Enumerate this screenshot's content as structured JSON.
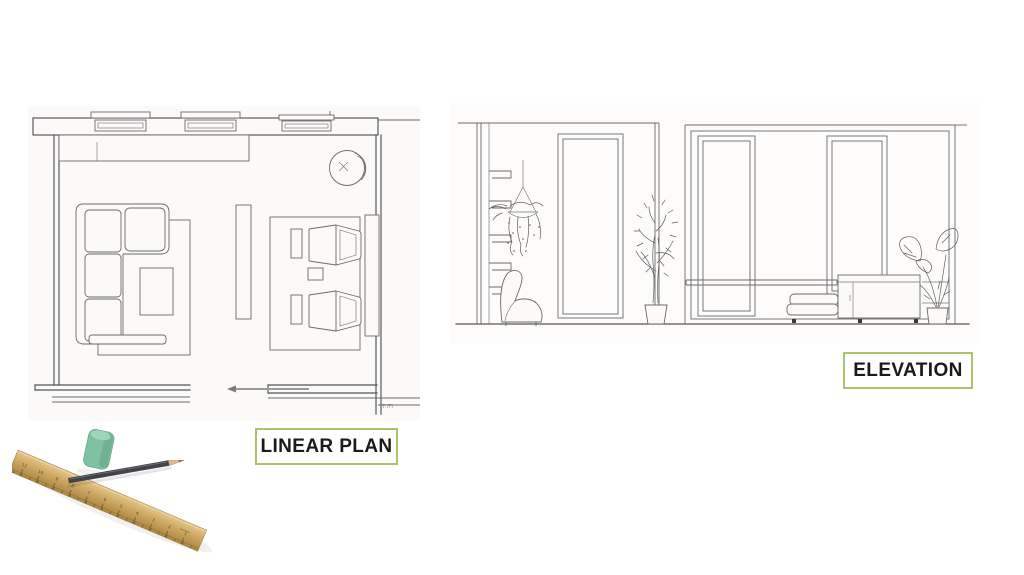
{
  "labels": {
    "linear_plan": "LINEAR PLAN",
    "elevation": "ELEVATION"
  },
  "plan": {
    "corner_note": "T.ITI"
  },
  "ruler": {
    "numbers": [
      "11",
      "10",
      "9",
      "8",
      "7",
      "6",
      "5",
      "4",
      "3",
      "2",
      "1"
    ]
  },
  "colors": {
    "label_border": "#a9c46d",
    "label_text": "#1a1a1a",
    "sketch_line": "#6a6a6a",
    "sketch_line_dark": "#555555",
    "paper": "#fbfaf8",
    "ruler_wood": "#cda761",
    "pencil_body": "#43454a",
    "eraser": "#7fc2a1"
  }
}
